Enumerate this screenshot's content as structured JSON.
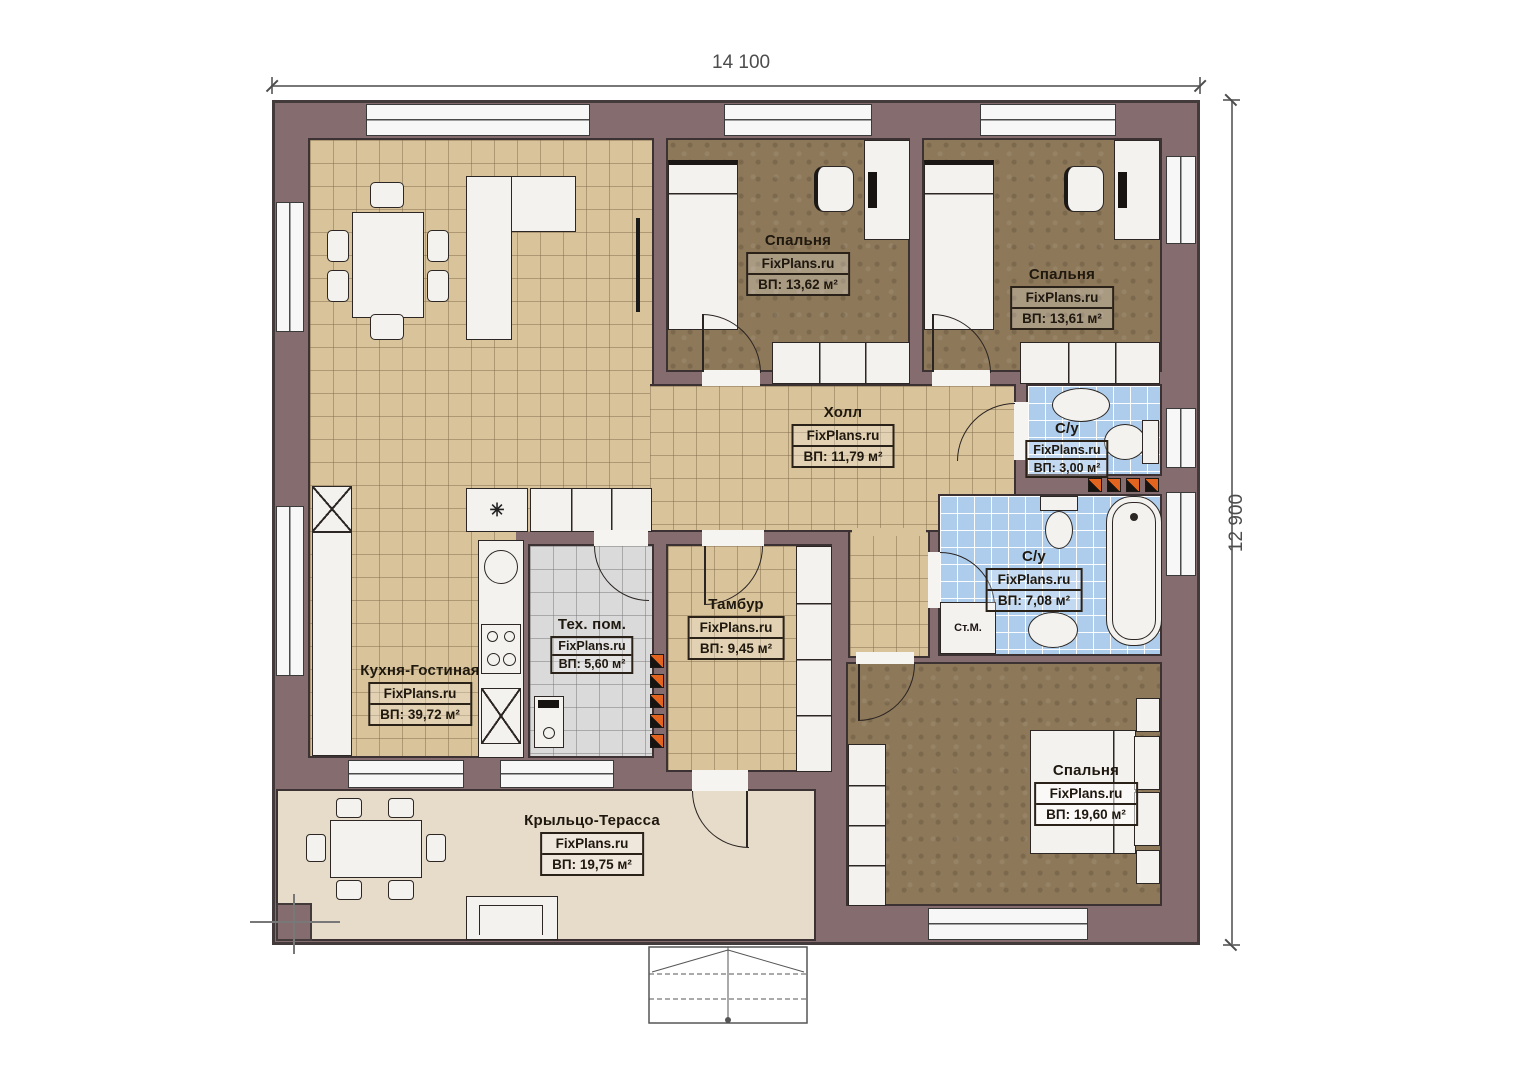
{
  "brand": "FixPlans.ru",
  "dimensions": {
    "width_label": "14 100",
    "height_label": "12 900"
  },
  "rooms": [
    {
      "id": "bedroom-1",
      "name": "Спальня",
      "brand": "FixPlans.ru",
      "area": "ВП: 13,62 м²"
    },
    {
      "id": "bedroom-2",
      "name": "Спальня",
      "brand": "FixPlans.ru",
      "area": "ВП: 13,61 м²"
    },
    {
      "id": "hall",
      "name": "Холл",
      "brand": "FixPlans.ru",
      "area": "ВП: 11,79 м²"
    },
    {
      "id": "wc-small",
      "name": "С/у",
      "brand": "FixPlans.ru",
      "area": "ВП: 3,00 м²"
    },
    {
      "id": "wc-big",
      "name": "С/у",
      "brand": "FixPlans.ru",
      "area": "ВП: 7,08 м²"
    },
    {
      "id": "tech-room",
      "name": "Тех. пом.",
      "brand": "FixPlans.ru",
      "area": "ВП: 5,60 м²"
    },
    {
      "id": "tambour",
      "name": "Тамбур",
      "brand": "FixPlans.ru",
      "area": "ВП: 9,45 м²"
    },
    {
      "id": "kitchen-living",
      "name": "Кухня-Гостиная",
      "brand": "FixPlans.ru",
      "area": "ВП: 39,72 м²"
    },
    {
      "id": "terrace",
      "name": "Крыльцо-Терасса",
      "brand": "FixPlans.ru",
      "area": "ВП: 19,75 м²"
    },
    {
      "id": "bedroom-master",
      "name": "Спальня",
      "brand": "FixPlans.ru",
      "area": "ВП: 19,60 м²"
    }
  ],
  "appliances": {
    "washing_machine": "Ст.М.",
    "fridge_symbol": "✳"
  },
  "colors": {
    "wall": "#856c6e",
    "wall_outline": "#433a3c",
    "tile_tan": "#d8c39a",
    "carpet_brown": "#8d7859",
    "tile_blue": "#aecdec",
    "tile_gray": "#dadada",
    "terrace_floor": "#e7dbc9",
    "accent_orange": "#e2641f",
    "furniture": "#f3f2ef"
  }
}
